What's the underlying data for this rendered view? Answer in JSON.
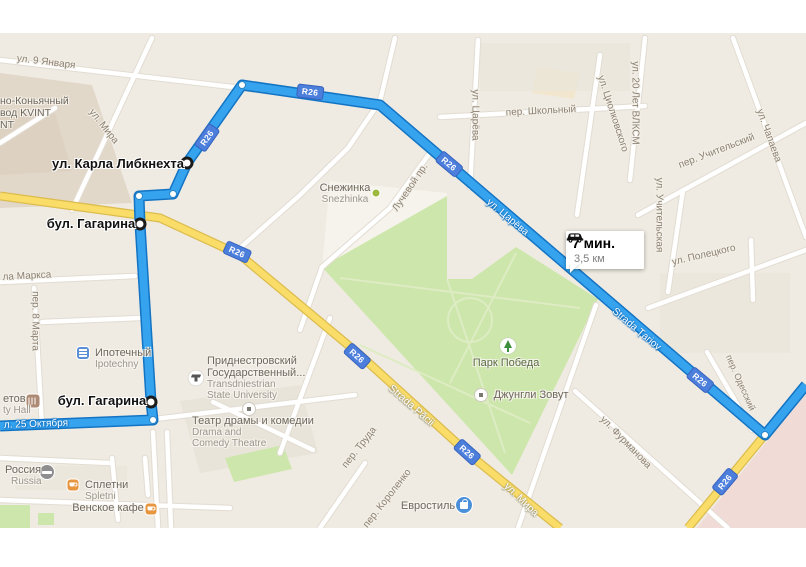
{
  "map_type": "google-maps-route-view",
  "badge_text": "R26",
  "tooltip": {
    "duration": "7 мин.",
    "distance": "3,5 км"
  },
  "waypoints": [
    {
      "label": "ул. Карла Либкнехта"
    },
    {
      "label": "бул. Гагарина"
    },
    {
      "label": "бул. Гагарина"
    }
  ],
  "route_street_labels": [
    "л. 25 Октября",
    "ул. Царёва",
    "Strada Țariov"
  ],
  "yellow_road_labels": [
    "Strada Păcii",
    "ул. Мира"
  ],
  "street_labels": [
    "ул. 9 Января",
    "ул. Мира",
    "ул. Царёва",
    "пер. Школьный",
    "ул. Циолковского",
    "ул. 20 Лет ВЛКСМ",
    "ул. Чапаева",
    "пер. Учительский",
    "ул. Учительская",
    "ул. Полецкого",
    "пер. Одесский",
    "ул. Фурманова",
    "пер. Труда",
    "пер. Короленко",
    "пер. 8 Марта",
    "ла Маркса",
    "Лучевой пр."
  ],
  "pois": {
    "kvint": {
      "line1": "но-Коньячный",
      "line2": "вод KVINT",
      "line3": "NT"
    },
    "snezhinka": {
      "name": "Снежинка",
      "alt": "Snezhinka"
    },
    "park": {
      "name": "Парк Победа"
    },
    "jungle": {
      "name": "Джунгли Зовут"
    },
    "theatre": {
      "name": "Театр драмы и комедии",
      "alt1": "Drama and",
      "alt2": "Comedy Theatre"
    },
    "university": {
      "line1": "Приднестровский",
      "line2": "Государственный...",
      "alt1": "Transdniestrian",
      "alt2": "State University"
    },
    "ipoteka": {
      "name": "Ипотечный",
      "alt": "Ipotechny"
    },
    "cityhall": {
      "name": "етов",
      "alt": "ty Hall"
    },
    "russia": {
      "name": "Россия",
      "alt": "Russia"
    },
    "spletni": {
      "name": "Сплетни",
      "alt": "Spletni"
    },
    "vienna": {
      "name": "Венское кафе"
    },
    "evrostil": {
      "name": "Евростиль"
    }
  },
  "colors": {
    "route_blue": "#36A3EF",
    "route_casing": "#1474C4",
    "road_yellow": "#FADD69",
    "road_yellow_casing": "#DCBC4E",
    "park_green": "#CDE6AB",
    "land": "#EFEBE2",
    "badge_blue": "#4C7EDC",
    "pink_zone": "#F1DBD7"
  }
}
